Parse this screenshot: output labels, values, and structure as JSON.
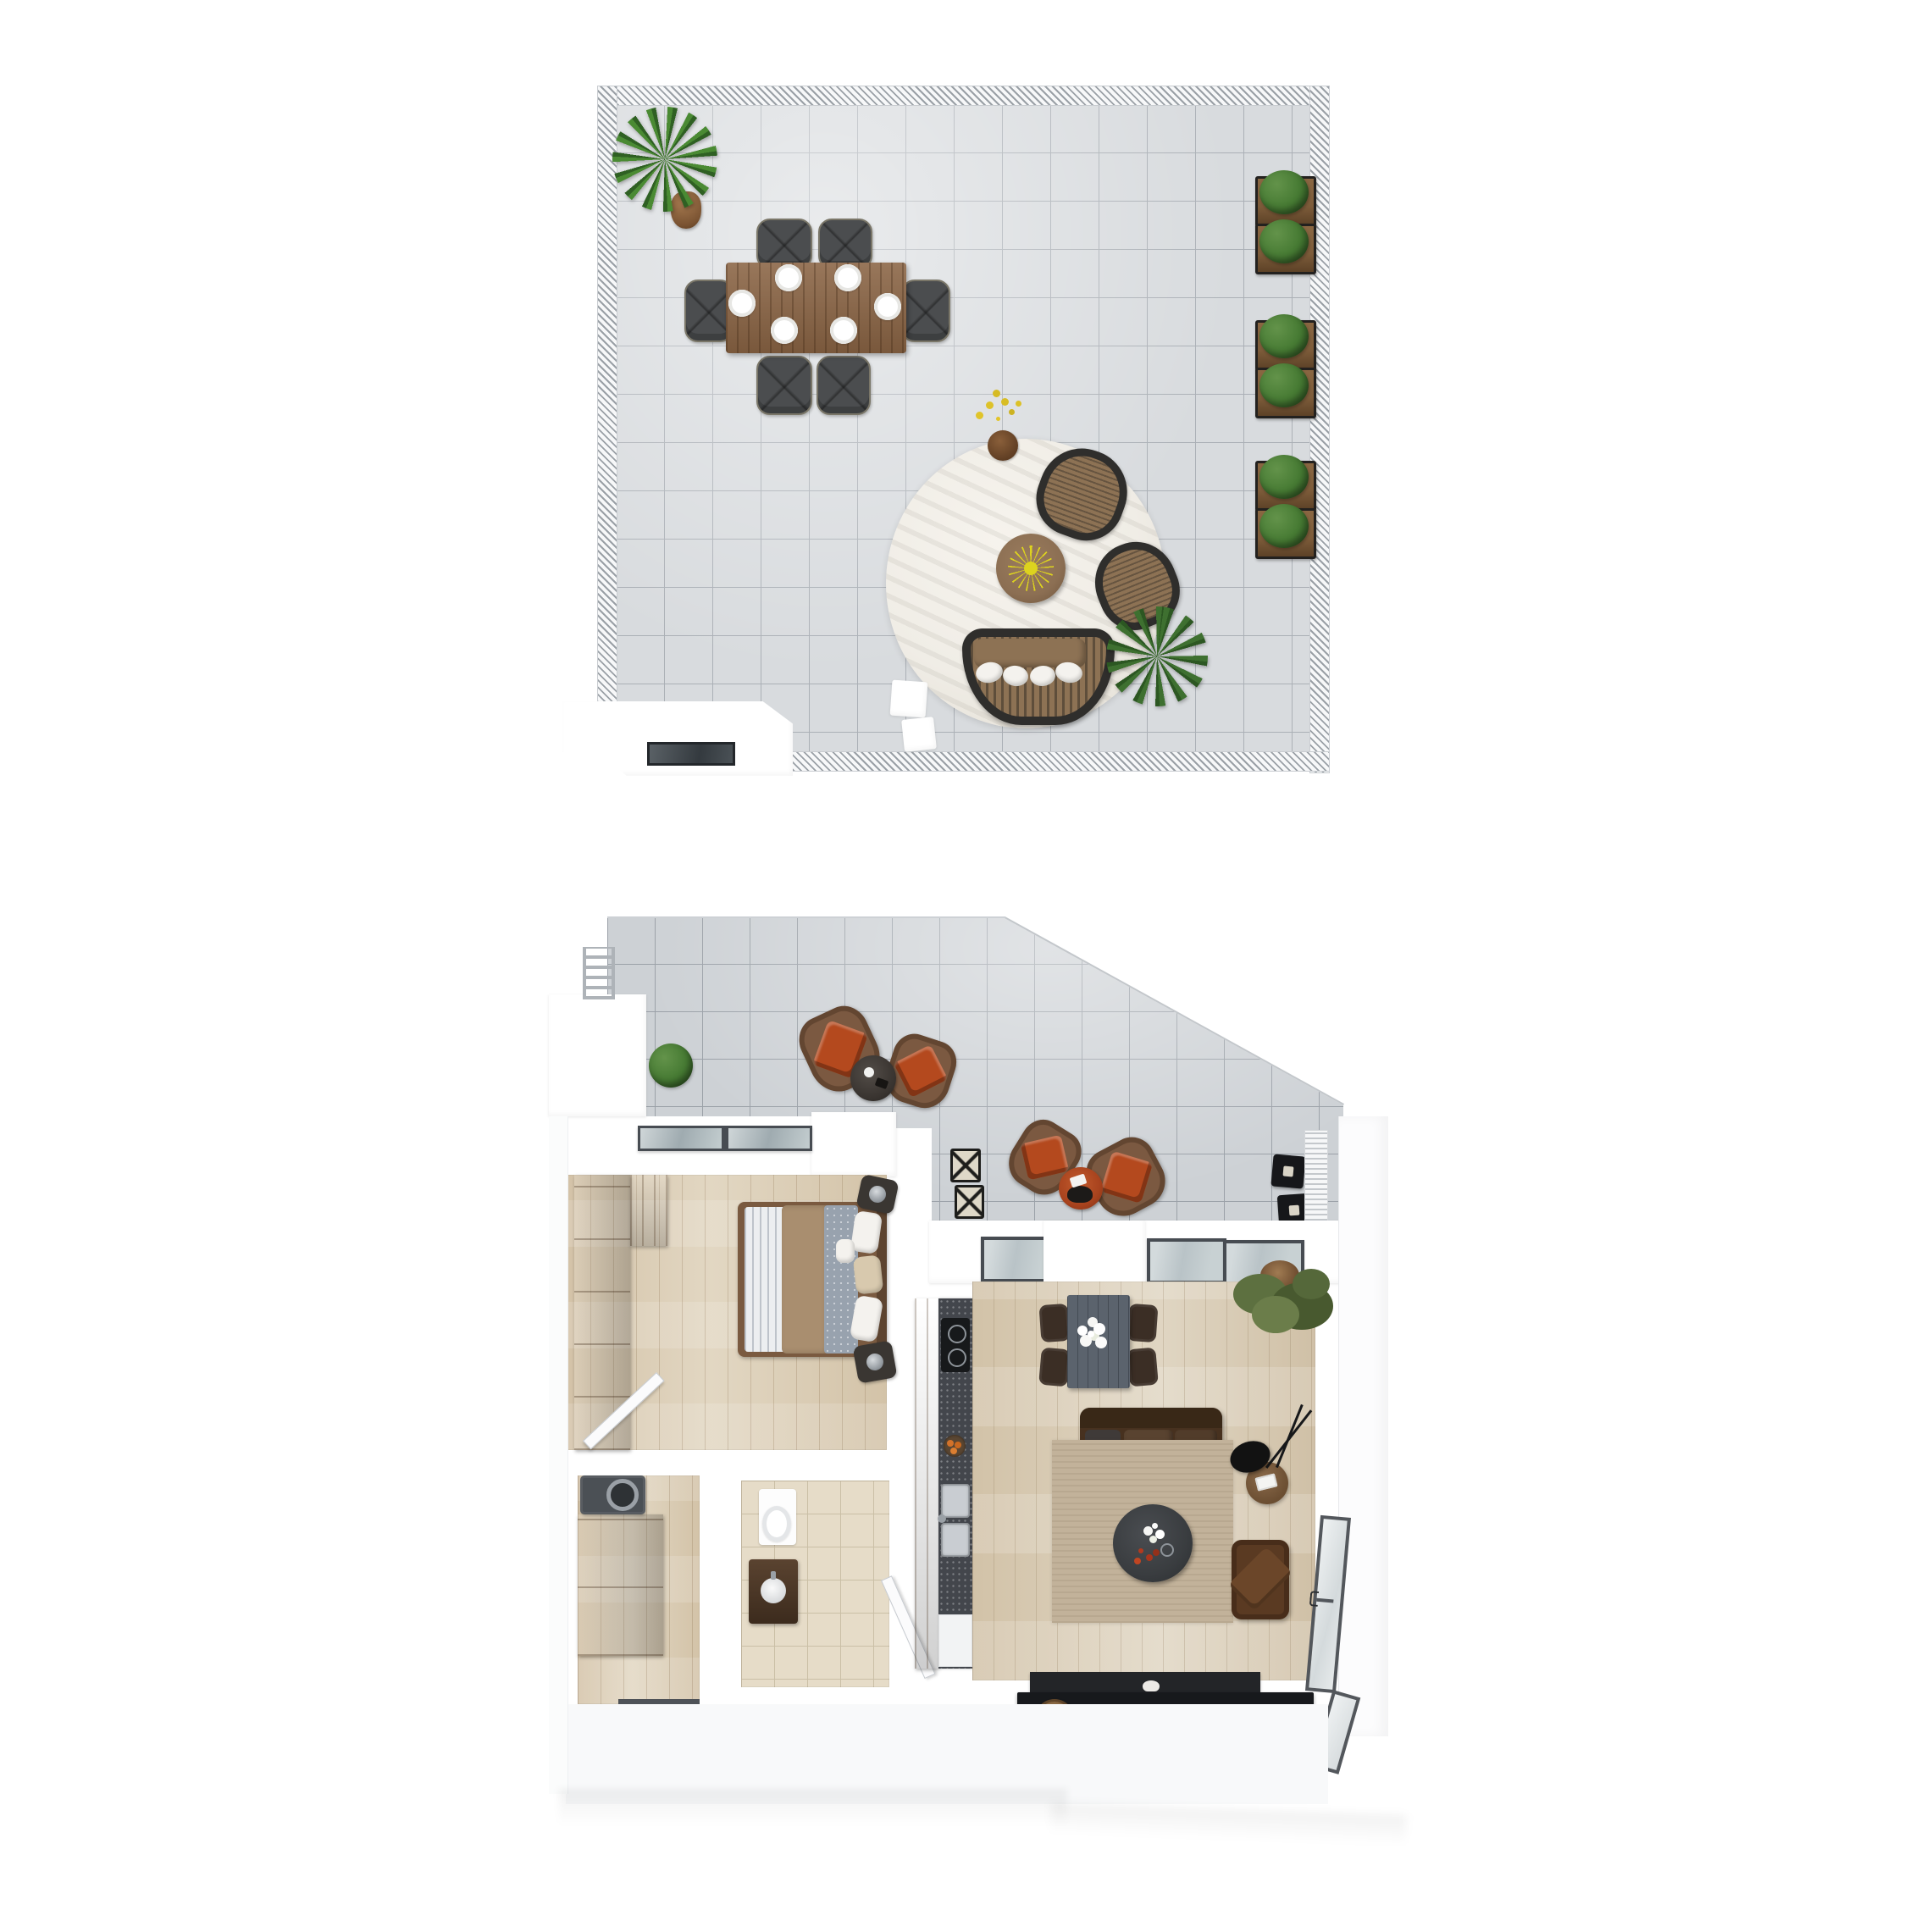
{
  "meta": {
    "description": "3D top-down floor plan render of a two-level penthouse: roof terrace (upper plan) and apartment level with wrap-around terrace (lower plan)",
    "view": "top-down axonometric",
    "levels": 2
  },
  "roof_terrace": {
    "label": "Roof terrace",
    "items": {
      "railing": {
        "label": "Perimeter railing"
      },
      "plant": {
        "label": "Large potted plant"
      },
      "dining_table": {
        "label": "Outdoor wooden dining table",
        "place_settings": 6
      },
      "dining_chairs": {
        "label": "Outdoor dining chairs",
        "count": 6
      },
      "rug": {
        "label": "Round outdoor rug"
      },
      "coffee_table": {
        "label": "Round coffee table with yellow centerpiece"
      },
      "wicker_chairs": {
        "label": "Wicker lounge chairs",
        "count": 2
      },
      "wicker_sofa": {
        "label": "Curved wicker sofa with pillows"
      },
      "palm": {
        "label": "Palm plant"
      },
      "flower_pot": {
        "label": "Small pot with yellow flowers"
      },
      "stools": {
        "label": "White cube stools",
        "count": 2
      },
      "planters": {
        "label": "Boxwood planter boxes",
        "count": 6
      },
      "bulkhead": {
        "label": "Stair bulkhead with skylight"
      }
    }
  },
  "apartment": {
    "label": "Apartment level",
    "rooms": {
      "terrace": {
        "label": "Terrace",
        "items": {
          "armchairs": {
            "label": "Lounge armchairs with orange cushions",
            "count": 4
          },
          "side_tables": {
            "label": "Terrace side tables",
            "count": 2
          },
          "stools": {
            "label": "Folding X-stools",
            "count": 2
          },
          "lanterns": {
            "label": "Cube lantern planters",
            "count": 2
          },
          "bush": {
            "label": "Bush plant"
          },
          "ladder": {
            "label": "Roof access ladder"
          },
          "grate": {
            "label": "Louvered grate"
          },
          "railing": {
            "label": "Terrace edge railing"
          }
        }
      },
      "bedroom": {
        "label": "Bedroom",
        "items": {
          "bed": {
            "label": "Double bed"
          },
          "wardrobe": {
            "label": "Wardrobe"
          },
          "nightstands": {
            "label": "Nightstands with lamps",
            "count": 2
          },
          "door": {
            "label": "Bedroom door"
          }
        }
      },
      "hallway": {
        "label": "Hallway",
        "items": {
          "washer": {
            "label": "Washing machine"
          },
          "cabinet": {
            "label": "Storage cabinet"
          }
        }
      },
      "bathroom": {
        "label": "Bathroom",
        "items": {
          "toilet": {
            "label": "Toilet"
          },
          "vanity": {
            "label": "Vanity with sink"
          },
          "door": {
            "label": "Bathroom door"
          }
        }
      },
      "kitchen": {
        "label": "Kitchen",
        "items": {
          "cabinets": {
            "label": "Base cabinets"
          },
          "cooktop": {
            "label": "Cooktop"
          },
          "sink": {
            "label": "Double sink"
          },
          "dishwasher": {
            "label": "Appliance front"
          }
        }
      },
      "living_room": {
        "label": "Living room",
        "items": {
          "dining_table": {
            "label": "Dining table with flowers"
          },
          "dining_chairs": {
            "label": "Dining chairs",
            "count": 4
          },
          "sofa": {
            "label": "Sofa"
          },
          "rug": {
            "label": "Area rug"
          },
          "coffee_table": {
            "label": "Round coffee table"
          },
          "side_table": {
            "label": "Side table"
          },
          "floor_lamp": {
            "label": "Black floor lamp"
          },
          "armchair": {
            "label": "Armchair"
          },
          "tv_console": {
            "label": "TV sideboard"
          },
          "tv": {
            "label": "Television panel"
          },
          "tree": {
            "label": "Potted tree"
          },
          "windows": {
            "label": "Windows"
          }
        }
      },
      "skylights": {
        "label": "Skylights over living area and bedroom"
      }
    }
  },
  "colors": {
    "canvas_bg": "#ffffff",
    "tile_light": "#d8dbde",
    "tile_light_line": "#abb0b6",
    "tile_mid": "#cdd1d5",
    "tile_mid_line": "#9ba1a8",
    "railing_hatch": "#9aa0a6",
    "wood_table": "#8a6444",
    "chair_gray": "#4b4d4f",
    "chair_rim": "#7a7668",
    "rug_round": "#f0ede6",
    "wicker_dark": "#2f2e2c",
    "cushion_tan": "#8d7254",
    "side_table_wood": "#8c6f53",
    "starburst_yellow": "#ddd31e",
    "palm_green": "#3e7030",
    "bush_green": "#467a33",
    "planter_wood": "#7d5c3a",
    "glass_pane": "#b9c3c7",
    "frame_dark": "#474c52",
    "terrace_chair_brown": "#7b5941",
    "cushion_orange": "#b4491e",
    "wood_floor": "#ddd0b8",
    "living_floor": "#d8cbb3",
    "wardrobe_wood": "#8a5c31",
    "bath_tile": "#e6dcc8",
    "bath_tile_line": "#cabfa6",
    "counter_dark": "#43464c",
    "cabinet_brown": "#7b4f2c",
    "dining_table_gray": "#5b636d",
    "dining_chair_brown": "#3b2e25",
    "sofa_brown": "#47311f",
    "rug_beige": "#c2b29a",
    "coffee_table_dark": "#3a3d40",
    "armchair_brown": "#5a3a22",
    "tv_black": "#17191c",
    "washer_gray": "#4b5055",
    "white_struct": "#ffffff",
    "door_white": "#fbfbfc"
  }
}
